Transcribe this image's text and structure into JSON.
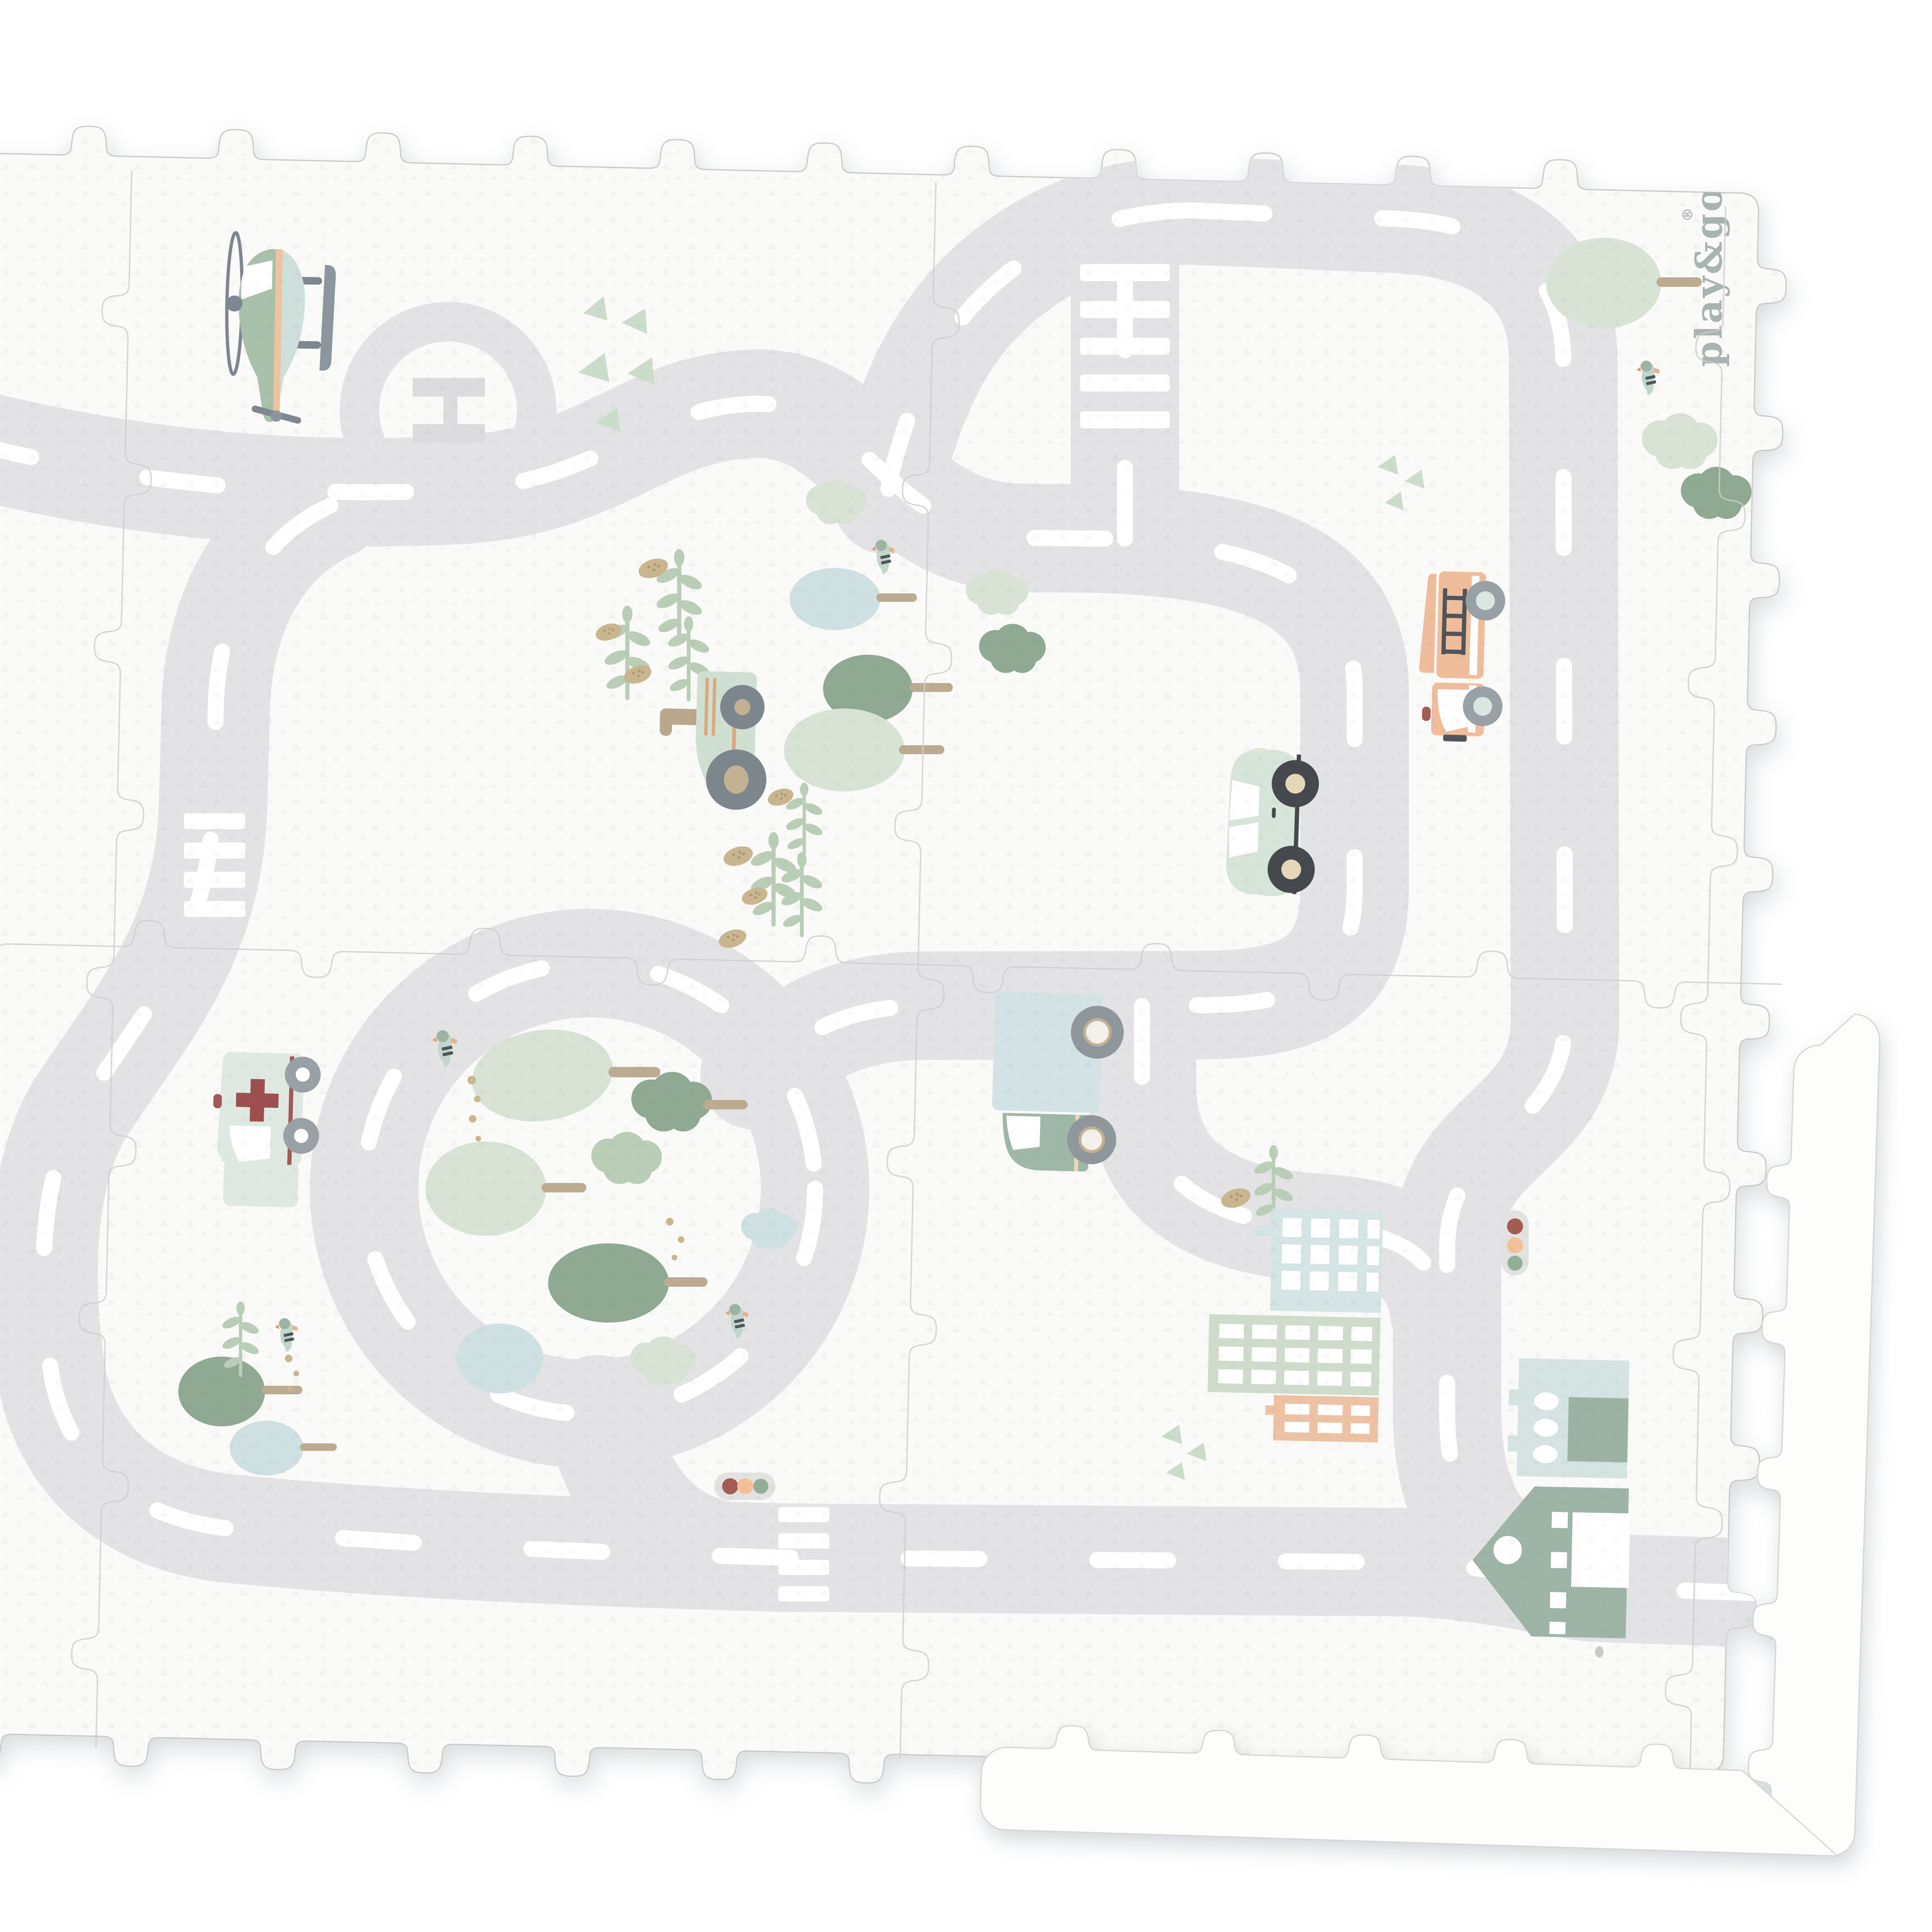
{
  "product": {
    "name": "foam puzzle playmat with road map print",
    "brand_logo_text": "play&go",
    "registered_mark": "®",
    "helipad_letter": "H"
  },
  "colors": {
    "page_bg": "#ffffff",
    "mat": "#fafaf8",
    "edge_piece": "#fdfdfc",
    "road": "#e3e3e5",
    "road_dash": "#ffffff",
    "seam": "#cfcfcd",
    "helipad_mark": "#dcdcde",
    "logo": "#a7b4b2",
    "signal_red": "#a35b54",
    "signal_amber": "#f3c097",
    "signal_green": "#93ae97",
    "helicopter_body": "#a9c0ab",
    "helicopter_side": "#cfdfdb",
    "helicopter_stripe": "#eec3a0",
    "fire_truck": "#f0bd9c",
    "car": "#d7e4d9",
    "tractor": "#cfe0d2",
    "ambulance": "#dfe9e2",
    "ambulance_cross": "#9d4f50",
    "truck_box": "#d3e2e4",
    "truck_cab": "#9fb7a7",
    "building_blue": "#d5e4e4",
    "building_sage": "#cfdccc",
    "building_peach": "#edc2a4",
    "garage": "#d5e4e2",
    "garage_door": "#9cb3a4",
    "house": "#9db4a6",
    "tree_sage_light": "#d8e3d6",
    "tree_sage": "#b9cdb7",
    "tree_teal": "#8fa992",
    "tree_blue": "#cfe0e3",
    "trunk_tan": "#bcab90",
    "wheel_gray": "#99a1a6",
    "wheel_dark": "#45484d",
    "hub_cream": "#e7d7ba",
    "pod_tan": "#c9b690"
  },
  "icons": [
    "helicopter-icon",
    "helipad-icon",
    "fire-truck-icon",
    "car-icon",
    "tractor-icon",
    "ambulance-icon",
    "delivery-truck-icon",
    "traffic-light-icon",
    "apartment-building-icon",
    "office-building-icon",
    "brick-building-icon",
    "garage-icon",
    "house-icon",
    "roundabout-icon",
    "crosswalk-icon",
    "tree-icon",
    "bird-icon",
    "sprig-icon",
    "seed-pod-icon",
    "triangle-decoration-icon",
    "puzzle-edge-piece-icon"
  ]
}
